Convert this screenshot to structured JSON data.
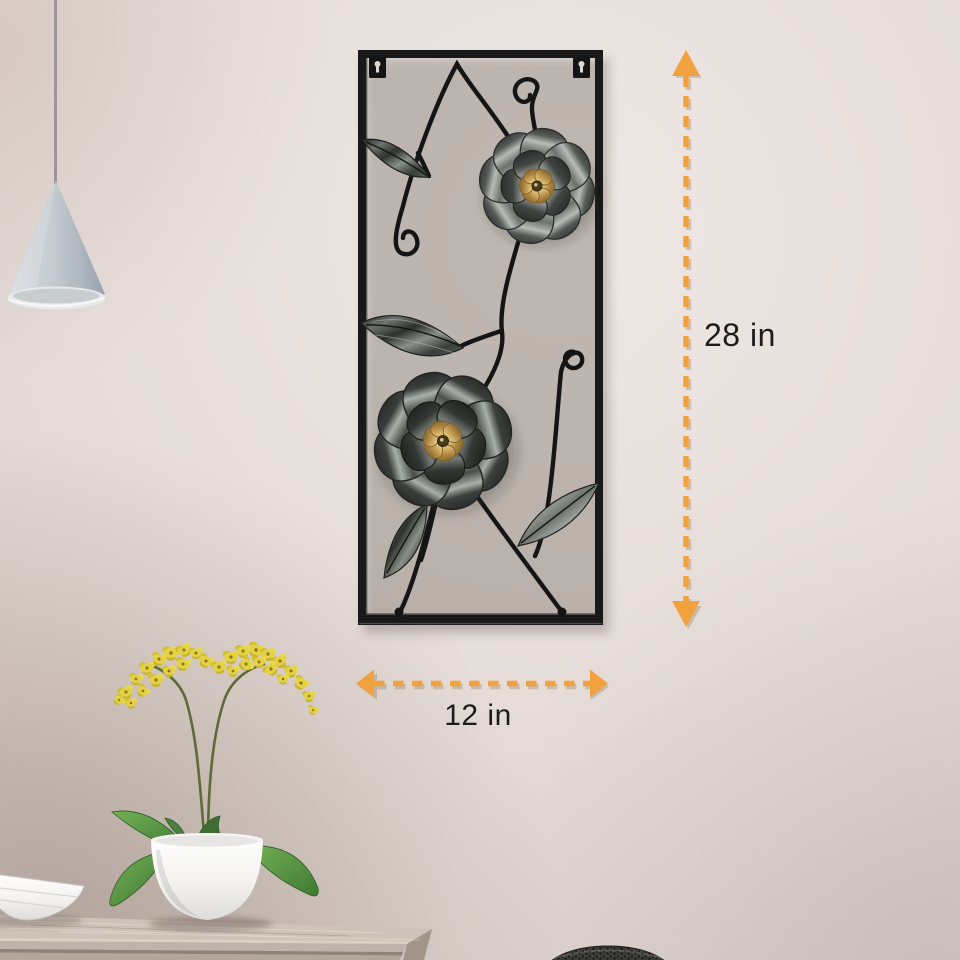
{
  "scene": {
    "kind": "product-photo",
    "product": "metal flower wall decor panel in black rectangular frame"
  },
  "annotations": {
    "height": {
      "label": "28 in"
    },
    "width": {
      "label": "12 in"
    }
  },
  "objects": {
    "wall_art": "black metal frame with scroll vines, metal leaves, two silver flowers with gold centers",
    "pendant_lamp": "gray cone pendant lamp on cord",
    "orchid": "yellow orchid with green leaves in white pot",
    "bowl": "white shallow bowl",
    "sideboard": "gray wooden sideboard",
    "basket": "dark woven basket edge"
  },
  "colors": {
    "arrow_orange": "#F1A23E",
    "label_text": "#1C1C1C",
    "wall": "#E7DEDB",
    "frame_black": "#191919",
    "petal_silver": "#8E938F",
    "flower_gold": "#C9A45A",
    "metal_leaf": "#4A4F4B",
    "orchid_yellow": "#E4D244",
    "plant_green": "#5F9C49",
    "pot_white": "#FAFAF9",
    "table_taupe": "#C6BBB0"
  }
}
